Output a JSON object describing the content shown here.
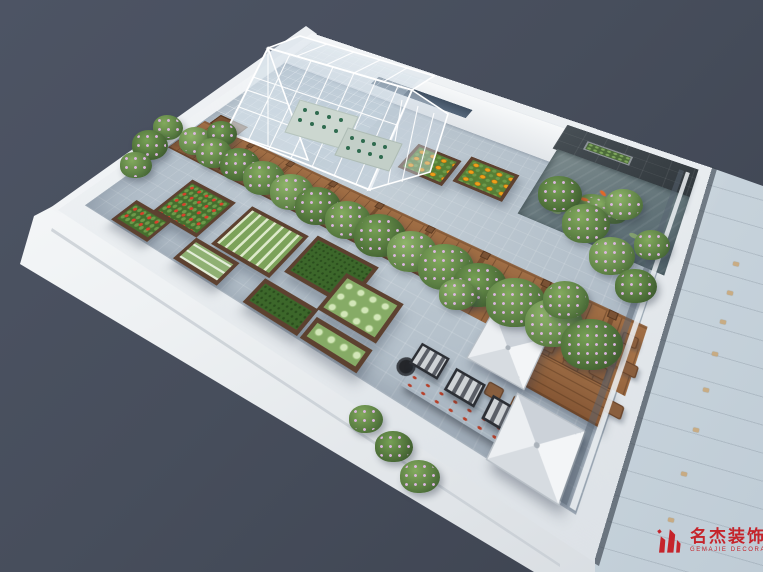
{
  "meta": {
    "type": "3d-architectural-render",
    "subject": "Rooftop garden design, aerial isometric rendering"
  },
  "watermark": {
    "brand_cn": "名杰装饰",
    "registered_mark": "®",
    "brand_en": "GEMAJIE DECORATION",
    "accent_color": "#c5242b"
  },
  "palette": {
    "background": "#474e5c",
    "parapet_white": "#eef1f3",
    "floor_pavers": "#b6c2cc",
    "deck_wood": "#96663f",
    "glass_facade": "#ccd7df",
    "feature_wall_slate": "#3d4449",
    "pond_water": "#64757a",
    "vine_foliage": "#5b7f43",
    "vine_flowers": "#d9aee0",
    "umbrella_canopy": "#eceff2",
    "window_stripe": "#47586a"
  },
  "scene": {
    "areas": [
      {
        "name": "greenhouse",
        "desc": "white-framed glass greenhouse with seedling benches"
      },
      {
        "name": "pergola-walkway",
        "desc": "timber deck walkway under flowering-vine pergola"
      },
      {
        "name": "vegetable-garden",
        "desc": "raised timber planter beds on blue-grey paver floor"
      },
      {
        "name": "koi-pond",
        "desc": "koi pond with slate feature wall, wall planter and plant island"
      },
      {
        "name": "dining-terrace",
        "desc": "long timber dining table with chairs and two canopy umbrellas"
      },
      {
        "name": "lounge-bbq-row",
        "desc": "striped sun loungers beside a black BBQ counter"
      }
    ]
  },
  "garden": {
    "beds": [
      {
        "type": "tomato",
        "label": "tomato bed",
        "x": 85,
        "y": 300,
        "w": 65,
        "h": 52
      },
      {
        "type": "tomato",
        "label": "tomato bed",
        "x": 58,
        "y": 350,
        "w": 55,
        "h": 30
      },
      {
        "type": "lettuce",
        "label": "lettuce rows bed",
        "x": 168,
        "y": 295,
        "w": 75,
        "h": 55
      },
      {
        "type": "seedling",
        "label": "seedling bed",
        "x": 150,
        "y": 352,
        "w": 58,
        "h": 28
      },
      {
        "type": "grass",
        "label": "turf bed",
        "x": 250,
        "y": 290,
        "w": 72,
        "h": 48
      },
      {
        "type": "grass",
        "label": "turf bed",
        "x": 240,
        "y": 352,
        "w": 62,
        "h": 28
      },
      {
        "type": "cabbage",
        "label": "cabbage bed",
        "x": 300,
        "y": 310,
        "w": 62,
        "h": 42
      },
      {
        "type": "cabbage",
        "label": "cabbage bed",
        "x": 305,
        "y": 358,
        "w": 58,
        "h": 22
      },
      {
        "type": "pumpkin",
        "label": "pumpkin bed",
        "x": 265,
        "y": 128,
        "w": 56,
        "h": 44
      },
      {
        "type": "pumpkin",
        "label": "pumpkin bed",
        "x": 327,
        "y": 116,
        "w": 58,
        "h": 44
      }
    ]
  },
  "dining": {
    "chair_count": 12,
    "umbrella_count": 2,
    "lounger_count": 3
  },
  "pond": {
    "koi_count": 3,
    "wall_planter_count": 1
  }
}
